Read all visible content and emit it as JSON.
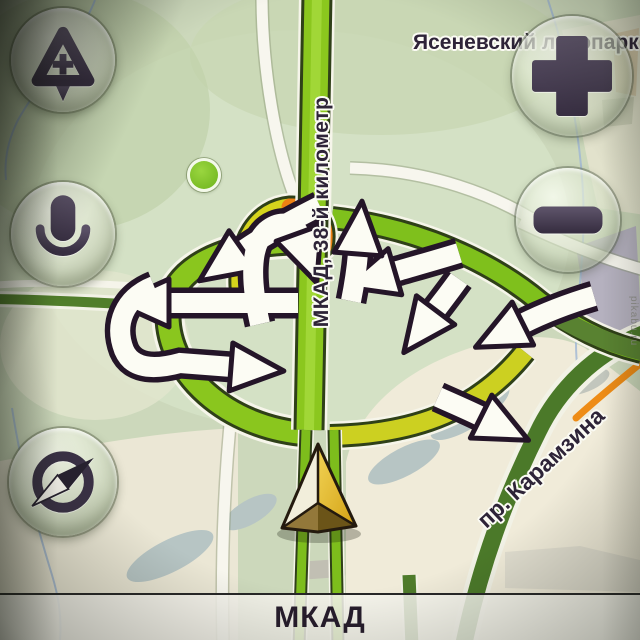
{
  "map": {
    "place_label": "Ясеневский лесопарк",
    "highway_label": "МКАД, 38-й километр",
    "street_label": "пр. Карамзина",
    "watermark": "pikabu.ru"
  },
  "status_bar": {
    "current_road": "МКАД"
  },
  "controls": {
    "add_event_icon": "road-event-add",
    "zoom_in_icon": "plus",
    "zoom_out_icon": "minus",
    "voice_icon": "microphone",
    "compass_icon": "compass"
  },
  "colors": {
    "highway_green": "#8bc71e",
    "ramp_yellow": "#ccd021",
    "traffic_jam_orange": "#ee8113",
    "road_dark_green": "#4b7929",
    "button_glyph": "#463c50",
    "label_dark": "#2e2438"
  }
}
